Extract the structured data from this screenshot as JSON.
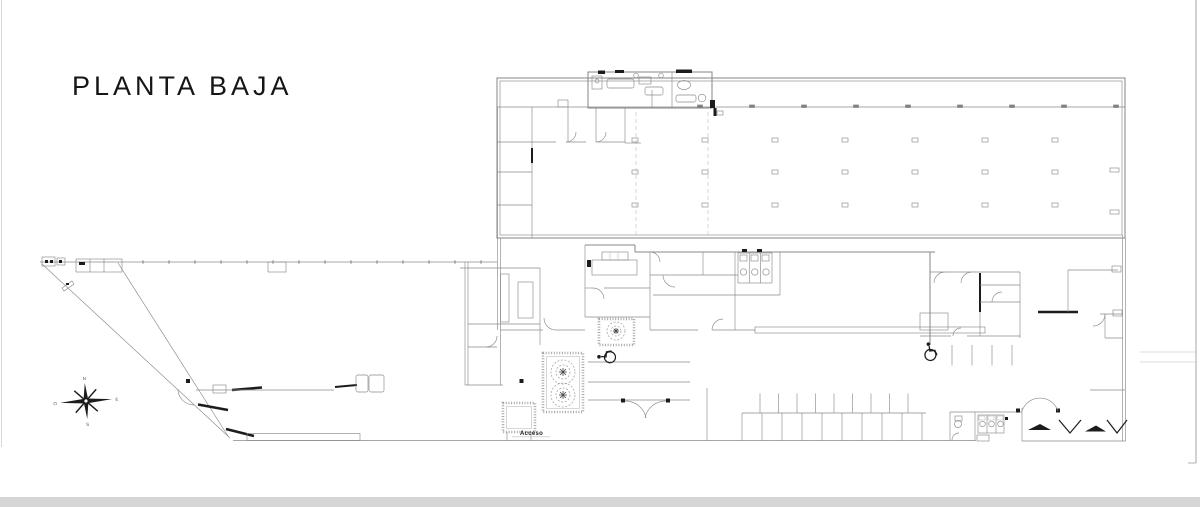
{
  "title": "PLANTA BAJA",
  "labels": {
    "access": "Acceso"
  },
  "compass": {
    "north": "N",
    "south": "S",
    "east": "E",
    "west": "O"
  },
  "colors": {
    "line": "#8a8a8a",
    "dark": "#1c1c1c",
    "sheet_edge": "#d6d6d6",
    "background": "#ffffff"
  }
}
